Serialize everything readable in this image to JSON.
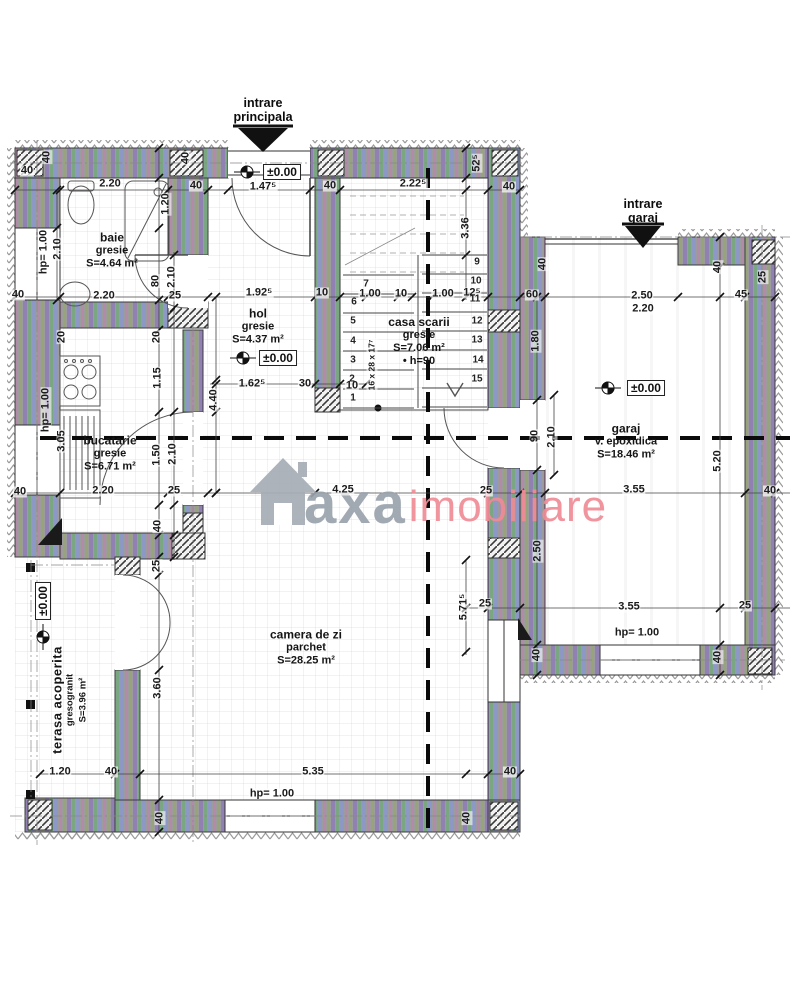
{
  "entries": {
    "principal_line1": "intrare",
    "principal_line2": "principala",
    "garage_line1": "intrare",
    "garage_line2": "garaj"
  },
  "levels": {
    "label": "±0.00"
  },
  "watermark": {
    "word1": "axa",
    "word2": "imobiliare",
    "color_gray": "#9aa2ac",
    "color_red": "#ef8b96"
  },
  "rooms": {
    "baie": {
      "name": "baie",
      "finish": "gresie",
      "area": "S=4.64 m²"
    },
    "hol": {
      "name": "hol",
      "finish": "gresie",
      "area": "S=4.37 m²"
    },
    "casa_scarii": {
      "name": "casa scarii",
      "finish": "gresie",
      "area": "S=7.06 m²",
      "extra": "• h=90"
    },
    "bucatarie": {
      "name": "bucatarie",
      "finish": "gresie",
      "area": "S=6.71 m²"
    },
    "garaj": {
      "name": "garaj",
      "finish": "v. epoxidica",
      "area": "S=18.46 m²"
    },
    "camera_de_zi": {
      "name": "camera de zi",
      "finish": "parchet",
      "area": "S=28.25 m²"
    },
    "terasa": {
      "name": "terasa acoperita",
      "finish": "gresogranit",
      "area": "S=3.96 m²"
    }
  },
  "stairs": {
    "numbers": [
      {
        "n": "1",
        "x": 353,
        "y": 398
      },
      {
        "n": "2",
        "x": 352,
        "y": 379
      },
      {
        "n": "3",
        "x": 353,
        "y": 360
      },
      {
        "n": "4",
        "x": 353,
        "y": 341
      },
      {
        "n": "5",
        "x": 353,
        "y": 321
      },
      {
        "n": "6",
        "x": 354,
        "y": 302
      },
      {
        "n": "7",
        "x": 366,
        "y": 284
      },
      {
        "n": "9",
        "x": 477,
        "y": 262
      },
      {
        "n": "10",
        "x": 476,
        "y": 281
      },
      {
        "n": "11",
        "x": 475,
        "y": 299
      },
      {
        "n": "12",
        "x": 477,
        "y": 321
      },
      {
        "n": "13",
        "x": 477,
        "y": 340
      },
      {
        "n": "14",
        "x": 478,
        "y": 360
      },
      {
        "n": "15",
        "x": 477,
        "y": 379
      }
    ]
  },
  "dimensions": [
    {
      "t": "40",
      "x": 27,
      "y": 171
    },
    {
      "t": "40",
      "x": 47,
      "y": 157,
      "r": 1
    },
    {
      "t": "2.20",
      "x": 110,
      "y": 184
    },
    {
      "t": "40",
      "x": 196,
      "y": 186
    },
    {
      "t": "40",
      "x": 186,
      "y": 158,
      "r": 1
    },
    {
      "t": "1.47⁵",
      "x": 263,
      "y": 187
    },
    {
      "t": "40",
      "x": 330,
      "y": 186
    },
    {
      "t": "2.22⁵",
      "x": 413,
      "y": 184
    },
    {
      "t": "52⁵",
      "x": 477,
      "y": 163,
      "r": 1
    },
    {
      "t": "40",
      "x": 509,
      "y": 187
    },
    {
      "t": "1.20",
      "x": 166,
      "y": 204,
      "r": 1
    },
    {
      "t": "hp= 1.00",
      "x": 44,
      "y": 252,
      "r": 1
    },
    {
      "t": "2.10",
      "x": 58,
      "y": 249,
      "r": 1
    },
    {
      "t": "3.36",
      "x": 466,
      "y": 228,
      "r": 1
    },
    {
      "t": "40",
      "x": 18,
      "y": 295
    },
    {
      "t": "2.20",
      "x": 104,
      "y": 296
    },
    {
      "t": "25",
      "x": 175,
      "y": 296
    },
    {
      "t": "80",
      "x": 156,
      "y": 281,
      "r": 1
    },
    {
      "t": "2.10",
      "x": 172,
      "y": 277,
      "r": 1
    },
    {
      "t": "1.92⁵",
      "x": 259,
      "y": 293
    },
    {
      "t": "10",
      "x": 322,
      "y": 293
    },
    {
      "t": "1.00",
      "x": 370,
      "y": 294
    },
    {
      "t": "10",
      "x": 401,
      "y": 294
    },
    {
      "t": "1.00",
      "x": 443,
      "y": 294
    },
    {
      "t": "12⁵",
      "x": 472,
      "y": 293
    },
    {
      "t": "60",
      "x": 532,
      "y": 295
    },
    {
      "t": "2.50",
      "x": 642,
      "y": 296
    },
    {
      "t": "2.20",
      "x": 643,
      "y": 309
    },
    {
      "t": "45",
      "x": 741,
      "y": 295
    },
    {
      "t": "40",
      "x": 543,
      "y": 264,
      "r": 1
    },
    {
      "t": "40",
      "x": 718,
      "y": 267,
      "r": 1
    },
    {
      "t": "25",
      "x": 763,
      "y": 277,
      "r": 1
    },
    {
      "t": "20",
      "x": 62,
      "y": 337,
      "r": 1
    },
    {
      "t": "20",
      "x": 157,
      "y": 337,
      "r": 1
    },
    {
      "t": "1.15",
      "x": 158,
      "y": 378,
      "r": 1
    },
    {
      "t": "1.62⁵",
      "x": 252,
      "y": 384
    },
    {
      "t": "30",
      "x": 305,
      "y": 384
    },
    {
      "t": "10",
      "x": 352,
      "y": 386
    },
    {
      "t": "4.40",
      "x": 214,
      "y": 400,
      "r": 1
    },
    {
      "t": "1.80",
      "x": 536,
      "y": 341,
      "r": 1
    },
    {
      "t": "16 x 28 x 17⁷",
      "x": 372,
      "y": 365,
      "r": 1,
      "s": 1
    },
    {
      "t": "hp= 1.00",
      "x": 46,
      "y": 410,
      "r": 1
    },
    {
      "t": "3.05",
      "x": 62,
      "y": 441,
      "r": 1
    },
    {
      "t": "1.50",
      "x": 157,
      "y": 455,
      "r": 1
    },
    {
      "t": "2.10",
      "x": 173,
      "y": 454,
      "r": 1
    },
    {
      "t": "90",
      "x": 535,
      "y": 436,
      "r": 1
    },
    {
      "t": "2.10",
      "x": 552,
      "y": 437,
      "r": 1
    },
    {
      "t": "40",
      "x": 20,
      "y": 492
    },
    {
      "t": "2.20",
      "x": 103,
      "y": 491
    },
    {
      "t": "25",
      "x": 174,
      "y": 491
    },
    {
      "t": "4.25",
      "x": 343,
      "y": 490
    },
    {
      "t": "25",
      "x": 486,
      "y": 491
    },
    {
      "t": "3.55",
      "x": 634,
      "y": 490
    },
    {
      "t": "40",
      "x": 770,
      "y": 491
    },
    {
      "t": "2.50",
      "x": 538,
      "y": 551,
      "r": 1
    },
    {
      "t": "5.20",
      "x": 718,
      "y": 461,
      "r": 1
    },
    {
      "t": "40",
      "x": 158,
      "y": 526,
      "r": 1
    },
    {
      "t": "25",
      "x": 157,
      "y": 566,
      "r": 1
    },
    {
      "t": "25",
      "x": 485,
      "y": 604
    },
    {
      "t": "5.71⁵",
      "x": 464,
      "y": 607,
      "r": 1
    },
    {
      "t": "3.55",
      "x": 629,
      "y": 607
    },
    {
      "t": "25",
      "x": 745,
      "y": 606
    },
    {
      "t": "hp= 1.00",
      "x": 637,
      "y": 633
    },
    {
      "t": "40",
      "x": 537,
      "y": 655,
      "r": 1
    },
    {
      "t": "40",
      "x": 718,
      "y": 657,
      "r": 1
    },
    {
      "t": "3.60",
      "x": 158,
      "y": 688,
      "r": 1
    },
    {
      "t": "1.20",
      "x": 60,
      "y": 772
    },
    {
      "t": "40",
      "x": 111,
      "y": 772
    },
    {
      "t": "5.35",
      "x": 313,
      "y": 772
    },
    {
      "t": "40",
      "x": 510,
      "y": 772
    },
    {
      "t": "hp= 1.00",
      "x": 272,
      "y": 794
    },
    {
      "t": "40",
      "x": 160,
      "y": 818,
      "r": 1
    },
    {
      "t": "40",
      "x": 467,
      "y": 818,
      "r": 1
    }
  ]
}
